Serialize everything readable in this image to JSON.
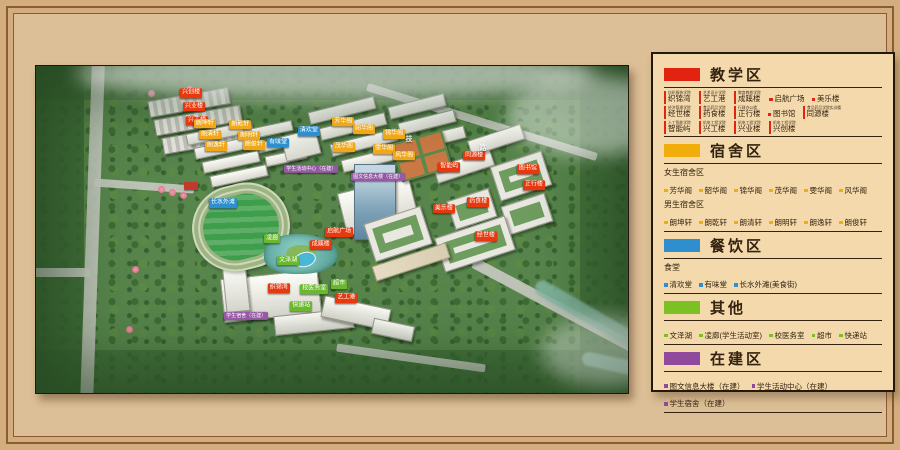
{
  "tag_colors": {
    "red": "#e8380d",
    "yellow": "#f0a818",
    "blue": "#2b8fd0",
    "green": "#6ab82d",
    "purple": "#9559a5"
  },
  "legend": {
    "sections": [
      {
        "id": "teaching",
        "title": "教学区",
        "color": "#e2230f",
        "blocks": [
          {
            "type": "tagged_row",
            "items": [
              {
                "caption": "纺织服装学院",
                "name": "织锦湾"
              },
              {
                "caption": "艺术设计学院",
                "name": "艺工港"
              },
              {
                "caption": "教育教养学院",
                "name": "成蹊楼"
              },
              {
                "name": "启航广场"
              },
              {
                "name": "美乐楼"
              }
            ]
          },
          {
            "type": "tagged_row",
            "items": [
              {
                "caption": "经济管理学院",
                "name": "经世楼"
              },
              {
                "caption": "食品药品学院",
                "name": "药食楼"
              },
              {
                "caption": "行政办公楼",
                "name": "正行楼"
              },
              {
                "name": "图书馆"
              },
              {
                "caption": "食品药品学院实训楼",
                "name": "同源楼"
              }
            ]
          },
          {
            "type": "tagged_row",
            "items": [
              {
                "caption": "人工智能学院",
                "name": "智能屿"
              },
              {
                "caption": "机电工程学院",
                "name": "兴工楼"
              },
              {
                "caption": "机电工程学院",
                "name": "兴业楼"
              },
              {
                "caption": "机电工程学院",
                "name": "兴创楼"
              }
            ]
          }
        ]
      },
      {
        "id": "dorm",
        "title": "宿舍区",
        "color": "#f0ad0c",
        "blocks": [
          {
            "type": "label",
            "text": "女生宿舍区"
          },
          {
            "type": "bullets",
            "items": [
              "芳华阁",
              "韶华阁",
              "锦华阁",
              "茂华阁",
              "雯华阁",
              "风华阁"
            ]
          },
          {
            "type": "label",
            "text": "男生宿舍区"
          },
          {
            "type": "bullets",
            "items": [
              "朗坤轩",
              "朗乾轩",
              "朗清轩",
              "朗明轩",
              "朗逸轩",
              "朗俊轩"
            ]
          }
        ]
      },
      {
        "id": "dining",
        "title": "餐饮区",
        "color": "#2f8ecd",
        "blocks": [
          {
            "type": "label",
            "text": "食堂"
          },
          {
            "type": "bullets",
            "items": [
              "清欢堂",
              "有味堂",
              "长水外滩(美食街)"
            ]
          }
        ]
      },
      {
        "id": "other",
        "title": "其他",
        "color": "#7cc123",
        "blocks": [
          {
            "type": "bullets",
            "items": [
              "文泽湖",
              "凌廊(学生活动室)",
              "校医务室",
              "超市",
              "快递站"
            ]
          }
        ]
      },
      {
        "id": "construction",
        "title": "在建区",
        "color": "#8f4a9c",
        "blocks": [
          {
            "type": "bullets",
            "items": [
              "图文信息大楼（在建）",
              "学生活动中心（在建）",
              "学生宿舍（在建）"
            ]
          }
        ]
      }
    ]
  },
  "map": {
    "road_name_chars": [
      {
        "text": "技",
        "x": 63.0,
        "y": 22.3
      },
      {
        "text": "路",
        "x": 75.5,
        "y": 25.0
      }
    ],
    "labels": [
      {
        "text": "兴创楼",
        "color": "red",
        "x": 26.2,
        "y": 8.3
      },
      {
        "text": "兴业楼",
        "color": "red",
        "x": 26.7,
        "y": 12.5
      },
      {
        "text": "兴工楼",
        "color": "red",
        "x": 27.2,
        "y": 16.8
      },
      {
        "text": "朗坤轩",
        "color": "yellow",
        "x": 28.5,
        "y": 17.7
      },
      {
        "text": "朗乾轩",
        "color": "yellow",
        "x": 34.5,
        "y": 18.0
      },
      {
        "text": "朗清轩",
        "color": "yellow",
        "x": 29.4,
        "y": 21.1
      },
      {
        "text": "朗明轩",
        "color": "yellow",
        "x": 36.0,
        "y": 21.4
      },
      {
        "text": "朗逸轩",
        "color": "yellow",
        "x": 30.4,
        "y": 24.5
      },
      {
        "text": "朗俊轩",
        "color": "yellow",
        "x": 36.8,
        "y": 24.2
      },
      {
        "text": "芳华阁",
        "color": "yellow",
        "x": 51.9,
        "y": 17.1
      },
      {
        "text": "韶华阁",
        "color": "yellow",
        "x": 55.4,
        "y": 19.3
      },
      {
        "text": "锦华阁",
        "color": "yellow",
        "x": 60.5,
        "y": 20.8
      },
      {
        "text": "茂华阁",
        "color": "yellow",
        "x": 52.0,
        "y": 24.8
      },
      {
        "text": "雯华阁",
        "color": "yellow",
        "x": 58.8,
        "y": 25.4
      },
      {
        "text": "风华阁",
        "color": "yellow",
        "x": 62.2,
        "y": 27.5
      },
      {
        "text": "清欢堂",
        "color": "blue",
        "x": 46.1,
        "y": 19.9
      },
      {
        "text": "有味堂",
        "color": "blue",
        "x": 40.9,
        "y": 23.5
      },
      {
        "text": "长水外滩",
        "color": "blue",
        "x": 31.6,
        "y": 41.9
      },
      {
        "text": "学生活动中心（在建）",
        "color": "purple",
        "x": 46.5,
        "y": 31.5
      },
      {
        "text": "图文信息大楼（在建）",
        "color": "purple",
        "x": 57.8,
        "y": 33.9
      },
      {
        "text": "学生宿舍（在建）",
        "color": "purple",
        "x": 35.5,
        "y": 76.5
      },
      {
        "text": "同源楼",
        "color": "red",
        "x": 74.0,
        "y": 27.5
      },
      {
        "text": "智能屿",
        "color": "red",
        "x": 69.8,
        "y": 30.9
      },
      {
        "text": "图书馆",
        "color": "red",
        "x": 83.1,
        "y": 31.5
      },
      {
        "text": "正行楼",
        "color": "red",
        "x": 84.1,
        "y": 36.4
      },
      {
        "text": "药食楼",
        "color": "red",
        "x": 74.7,
        "y": 41.6
      },
      {
        "text": "美乐楼",
        "color": "red",
        "x": 68.9,
        "y": 43.7
      },
      {
        "text": "经世楼",
        "color": "red",
        "x": 76.0,
        "y": 52.0
      },
      {
        "text": "成蹊楼",
        "color": "red",
        "x": 48.1,
        "y": 54.7
      },
      {
        "text": "启航广场",
        "color": "red",
        "x": 51.2,
        "y": 50.8
      },
      {
        "text": "织锦湾",
        "color": "red",
        "x": 41.0,
        "y": 67.9
      },
      {
        "text": "艺工港",
        "color": "red",
        "x": 52.4,
        "y": 71.0
      },
      {
        "text": "凌廊",
        "color": "green",
        "x": 39.9,
        "y": 52.9
      },
      {
        "text": "文泽湖",
        "color": "green",
        "x": 42.6,
        "y": 59.6
      },
      {
        "text": "校医务室",
        "color": "green",
        "x": 47.0,
        "y": 68.2
      },
      {
        "text": "超市",
        "color": "green",
        "x": 51.2,
        "y": 66.7
      },
      {
        "text": "快递站",
        "color": "green",
        "x": 44.8,
        "y": 73.4
      }
    ]
  }
}
